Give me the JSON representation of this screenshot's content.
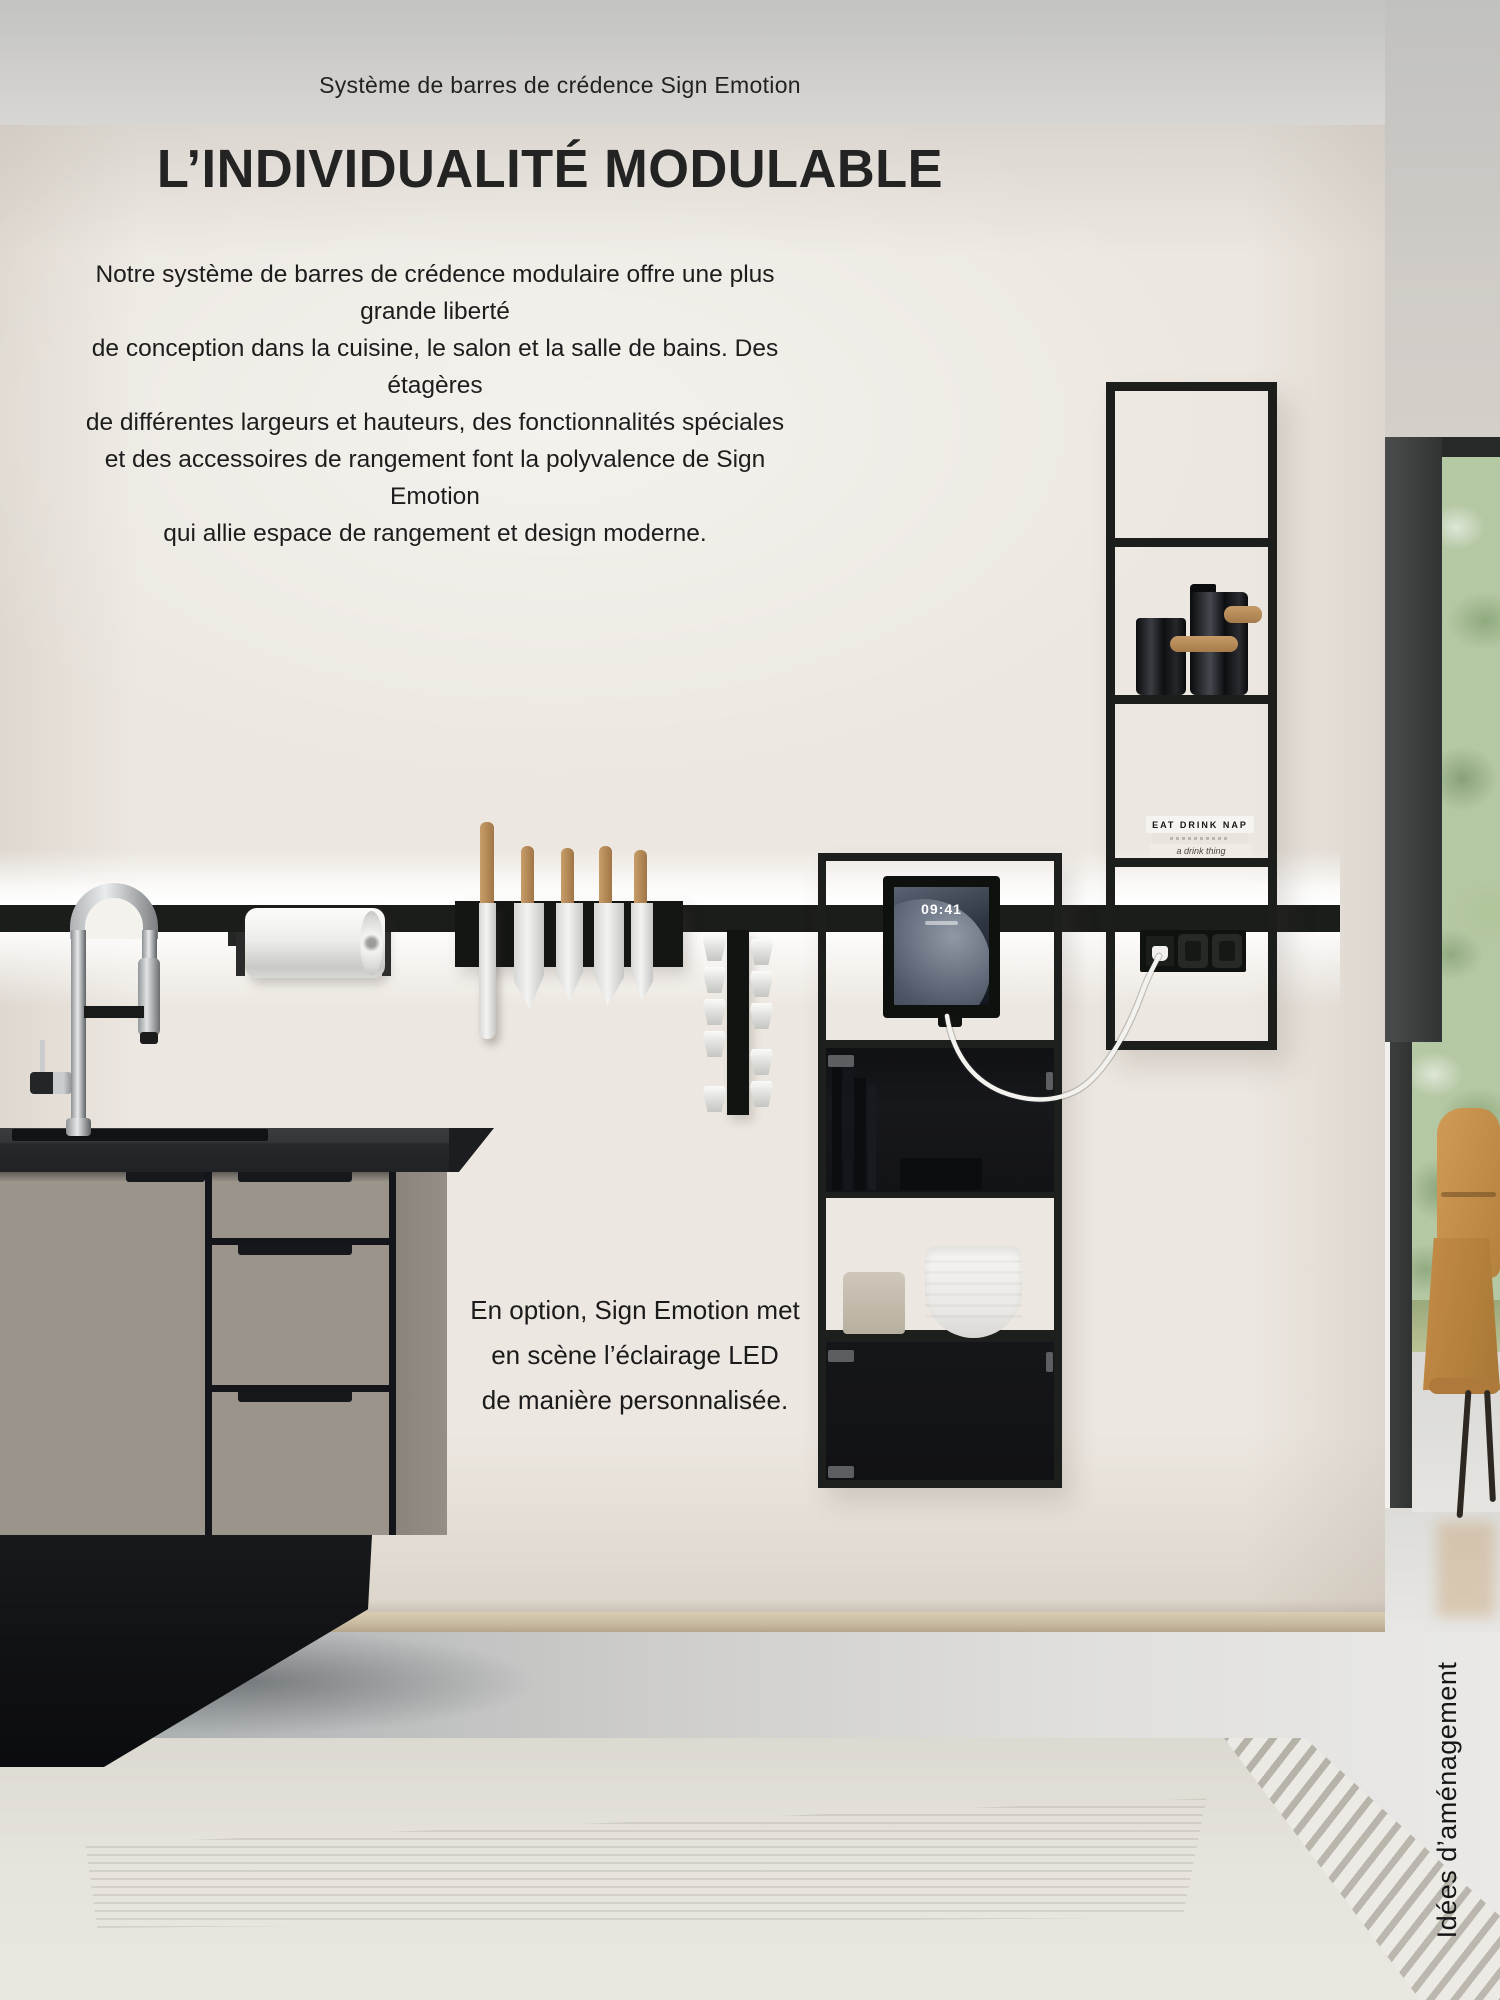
{
  "page": {
    "kicker": "Système de barres de crédence Sign Emotion",
    "headline": "L’INDIVIDUALITÉ MODULABLE",
    "intro_lines": [
      "Notre système de barres de crédence modulaire offre une plus grande liberté",
      "de conception dans la cuisine, le salon et la salle de bains. Des étagères",
      "de différentes largeurs et hauteurs, des fonctionnalités spéciales",
      "et des accessoires de rangement font la polyvalence de Sign Emotion",
      "qui allie espace de rangement et design moderne."
    ],
    "caption_lines": [
      "En option, Sign Emotion met",
      "en scène l’éclairage LED",
      "de manière personnalisée."
    ],
    "side_label": "Idées d’aménagement"
  },
  "photo": {
    "tablet_time": "09:41",
    "book_spines": [
      "EAT DRINK NAP",
      "a drink thing"
    ],
    "colors": {
      "wall": "#ece7e0",
      "ceiling": "#cfcecb",
      "rail_black": "#1b1d1b",
      "cabinet_taupe": "#9b948b",
      "countertop": "#26282c",
      "wood_handle": "#b98f5f",
      "greenery": "#b5c8a4",
      "chair_tan": "#c08b4f",
      "rug": "#e4e1da"
    }
  }
}
